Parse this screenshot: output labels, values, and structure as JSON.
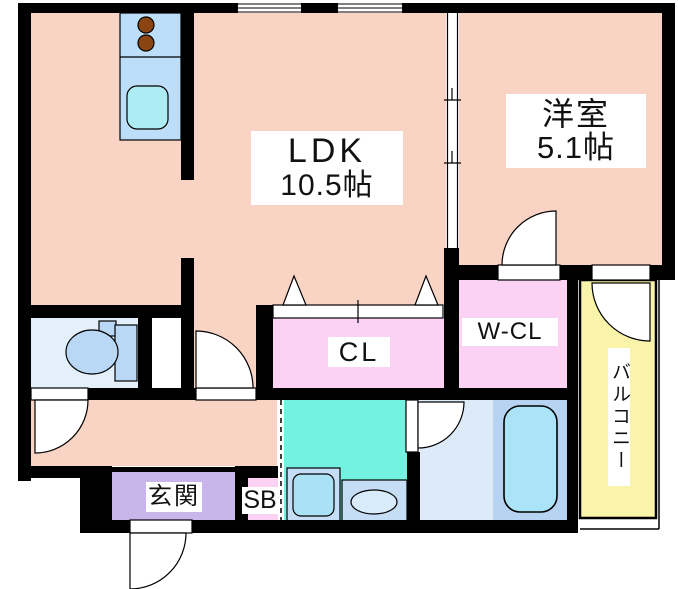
{
  "plan": {
    "rooms": {
      "ldk": {
        "label": "LDK",
        "size": "10.5帖"
      },
      "western_room": {
        "label": "洋室",
        "size": "5.1帖"
      },
      "closet": {
        "label": "CL"
      },
      "walk_in_closet": {
        "label": "W-CL"
      },
      "balcony": {
        "label": "バルコニー"
      },
      "entrance": {
        "label": "玄関"
      },
      "shoe_box": {
        "label": "SB"
      }
    },
    "fixtures": [
      "kitchen-stove-2-burner",
      "kitchen-sink",
      "toilet",
      "washing-machine-pan",
      "washbasin",
      "bathtub"
    ],
    "colors": {
      "wall": "#000000",
      "floor_main": "#F9D3C4",
      "closet_pink": "#FBD1F4",
      "entrance_purple": "#C8B6EA",
      "toilet_room_blue": "#E3F0FC",
      "fixture_blue": "#B9D8F5",
      "kitchen_counter_blue": "#BCDEF8",
      "sink_cyan": "#ACECF2",
      "burner_brown": "#8B4513",
      "washroom_cyan": "#74F1E0",
      "washer_pan_blue": "#C5DDF5",
      "washer_inner_blue": "#A9E2F5",
      "basin_oval_blue": "#D8EBFA",
      "bath_floor_blue": "#DDEBF9",
      "tub_zone_blue": "#B6D3F1",
      "tub_fill_blue": "#ABE4F8",
      "balcony_yellow": "#F9F4A9",
      "door_white": "#FFFFFF"
    }
  }
}
